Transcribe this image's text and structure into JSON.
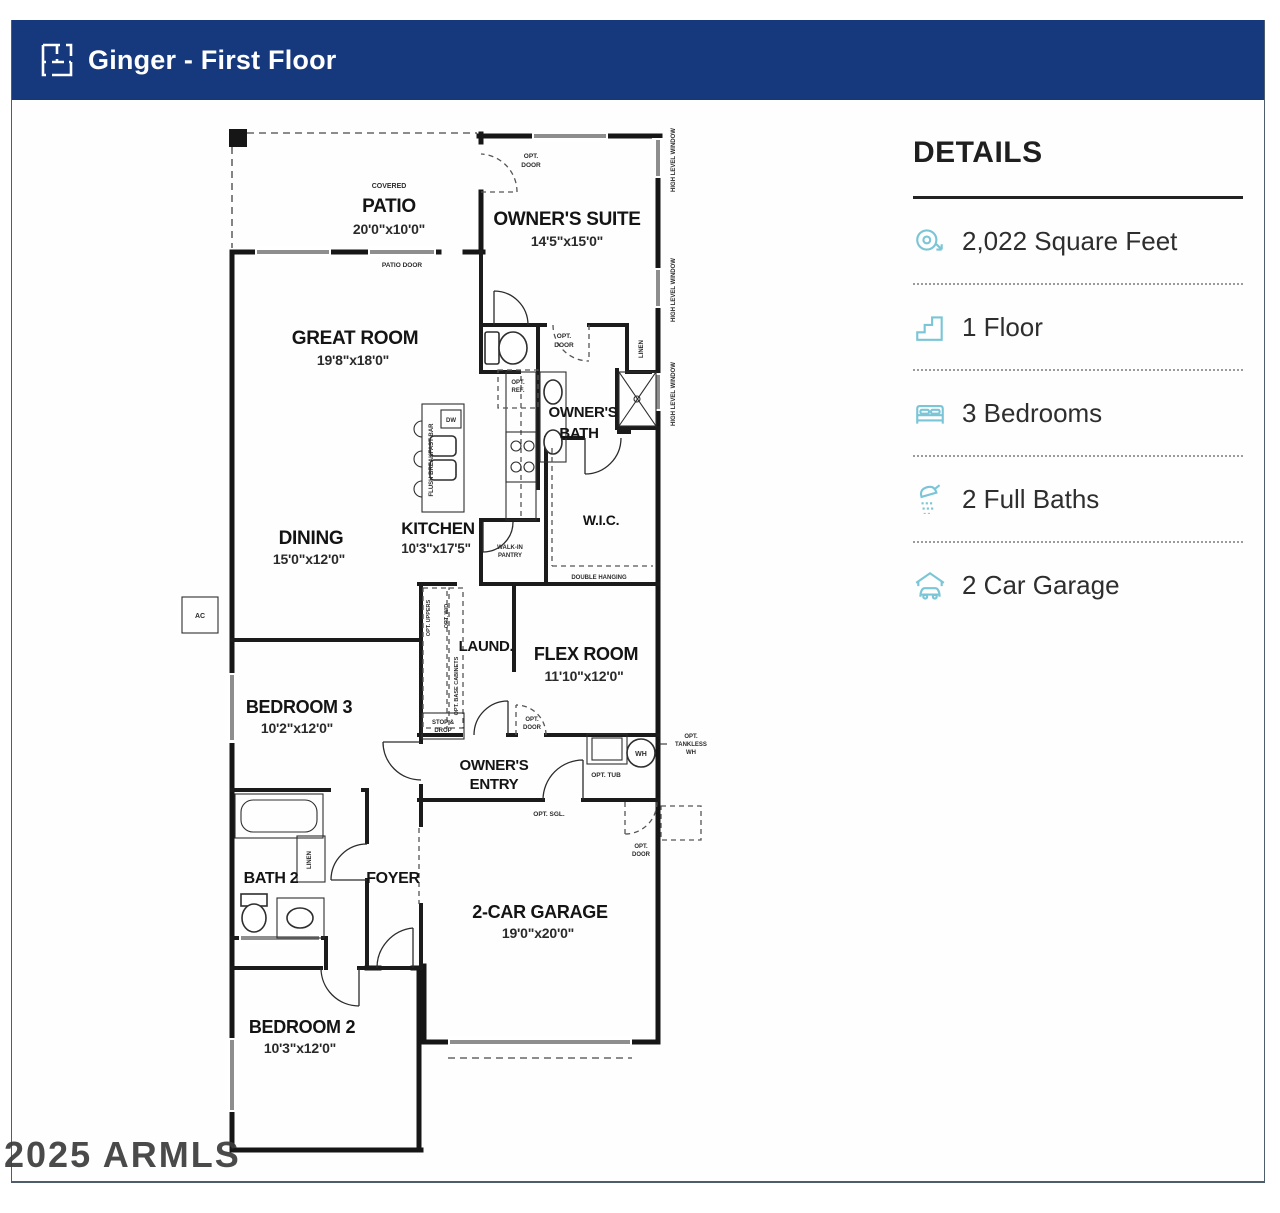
{
  "header": {
    "title": "Ginger - First Floor",
    "icon": "floorplan-icon"
  },
  "details": {
    "title": "DETAILS",
    "items": [
      {
        "icon": "tape-measure-icon",
        "label": "2,022 Square Feet"
      },
      {
        "icon": "stairs-icon",
        "label": "1 Floor"
      },
      {
        "icon": "bed-icon",
        "label": "3 Bedrooms"
      },
      {
        "icon": "shower-icon",
        "label": "2 Full Baths"
      },
      {
        "icon": "car-garage-icon",
        "label": "2 Car Garage"
      }
    ],
    "icon_color": "#7ac5d6",
    "header_color": "#16387c"
  },
  "floorplan": {
    "rooms": {
      "patio": {
        "sub": "COVERED",
        "name": "PATIO",
        "dims": "20'0\"x10'0\""
      },
      "owners_suite": {
        "name": "OWNER'S SUITE",
        "dims": "14'5\"x15'0\""
      },
      "great_room": {
        "name": "GREAT ROOM",
        "dims": "19'8\"x18'0\""
      },
      "owners_bath": {
        "line1": "OWNER'S",
        "line2": "BATH"
      },
      "kitchen": {
        "name": "KITCHEN",
        "dims": "10'3\"x17'5\""
      },
      "dining": {
        "name": "DINING",
        "dims": "15'0\"x12'0\""
      },
      "wic": {
        "name": "W.I.C."
      },
      "laundry": {
        "name": "LAUND."
      },
      "flex": {
        "name": "FLEX ROOM",
        "dims": "11'10\"x12'0\""
      },
      "bedroom3": {
        "name": "BEDROOM 3",
        "dims": "10'2\"x12'0\""
      },
      "owners_entry": {
        "line1": "OWNER'S",
        "line2": "ENTRY"
      },
      "bath2": {
        "name": "BATH 2"
      },
      "foyer": {
        "name": "FOYER"
      },
      "garage": {
        "name": "2-CAR GARAGE",
        "dims": "19'0\"x20'0\""
      },
      "bedroom2": {
        "name": "BEDROOM 2",
        "dims": "10'3\"x12'0\""
      }
    },
    "labels": {
      "patio_door": "PATIO DOOR",
      "opt": "OPT.",
      "door": "DOOR",
      "high_level_window": "HIGH LEVEL WINDOW",
      "linen": "LINEN",
      "opt_ref_1": "OPT.",
      "opt_ref_2": "REF.",
      "walk_in": "WALK-IN",
      "pantry": "PANTRY",
      "double_hanging": "DOUBLE HANGING",
      "flush_bar": "FLUSH BREAKFAST BAR",
      "dw": "DW",
      "opt_uppers": "OPT. UPPERS",
      "opt_wd": "OPT. W/D",
      "opt_base": "OPT. BASE CABINETS",
      "stop_1": "STOP &",
      "stop_2": "DROP",
      "opt_tub": "OPT. TUB",
      "wh": "WH",
      "tankless_1": "OPT.",
      "tankless_2": "TANKLESS",
      "tankless_3": "WH",
      "opt_sgl": "OPT. SGL.",
      "ac": "AC"
    }
  },
  "watermark": {
    "text": "2025 ARMLS"
  }
}
